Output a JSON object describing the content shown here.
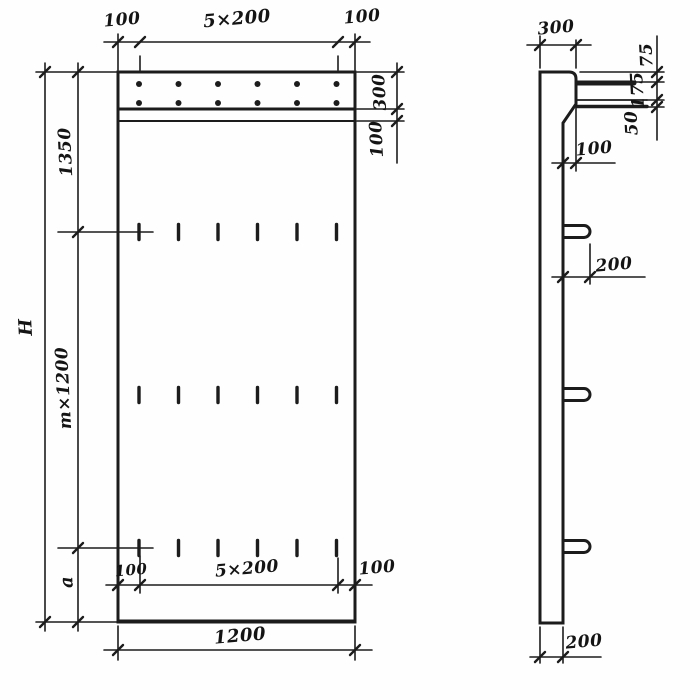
{
  "front_view": {
    "top_dims": {
      "left_margin": "100",
      "hole_spacing": "5×200",
      "right_margin": "100"
    },
    "right_dims": {
      "top_strip": "300",
      "band": "100"
    },
    "left_dims": {
      "overall_height": "H",
      "top_section": "1350",
      "module_section": "m×1200",
      "bottom_section": "a"
    },
    "bottom_dims": {
      "left_margin": "100",
      "slot_spacing": "5×200",
      "right_margin": "100",
      "overall_width": "1200"
    }
  },
  "side_view": {
    "top_width": "300",
    "edge_dims": {
      "seg_top": "75",
      "seg_mid": "175",
      "seg_bottom": "50"
    },
    "step_offset": "100",
    "hook_projection": "200",
    "panel_thickness": "200"
  }
}
